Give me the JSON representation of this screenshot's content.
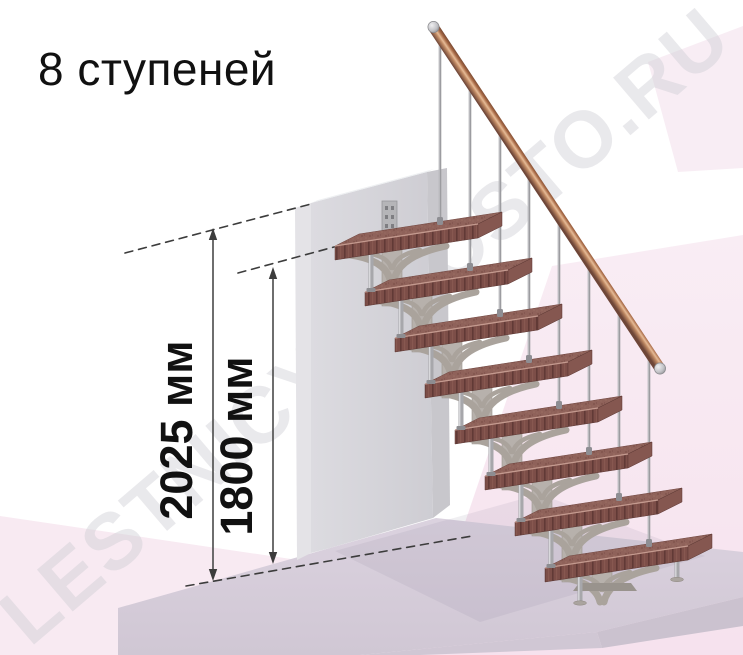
{
  "title": "8 ступеней",
  "watermark_text": "LESTNICY-PROSTO.RU",
  "dims": [
    {
      "name": "overall-height",
      "label": "2025 мм",
      "value_mm": 2025
    },
    {
      "name": "height-to-top-step",
      "label": "1800 мм",
      "value_mm": 1800
    }
  ],
  "stairs": {
    "step_count": 8,
    "colors": {
      "wood_top": "#8f625a",
      "wood_front": "#7c4e48",
      "wood_stripe": "#613a36",
      "wood_end": "#855750",
      "wood_edge_highlight": "#c49a8f",
      "spine": "#b7b1ac",
      "arm": "#aaa39c",
      "metal": "#a7a7ab",
      "metal_light": "#d8d8db",
      "rail_light": "#e2b18c",
      "rail_dark": "#6e4638",
      "wall": "#d5d4d9",
      "floor": "#d8cfdc",
      "pink_wash": "#f8eaf2",
      "dim_line": "#3c3c3c",
      "text": "#111111",
      "watermark": "#cdccd3"
    }
  }
}
